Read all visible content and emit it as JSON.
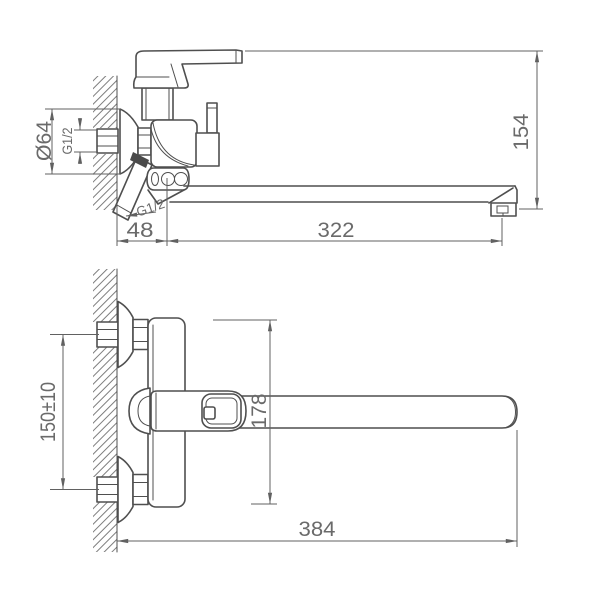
{
  "colors": {
    "line": "#4f4f4f",
    "dimension": "#616161",
    "text": "#6a6a6a",
    "seal_fill": "#4a4a4a",
    "background": "#ffffff"
  },
  "side_view": {
    "labels": {
      "flange_diameter": "Ø64",
      "inlet_thread": "G1/2",
      "shower_thread": "G1/2",
      "wall_offset": "48",
      "spout_reach": "322",
      "overall_height": "154"
    }
  },
  "plan_view": {
    "labels": {
      "inlet_spacing": "150±10",
      "body_depth": "178",
      "overall_length": "384"
    }
  }
}
